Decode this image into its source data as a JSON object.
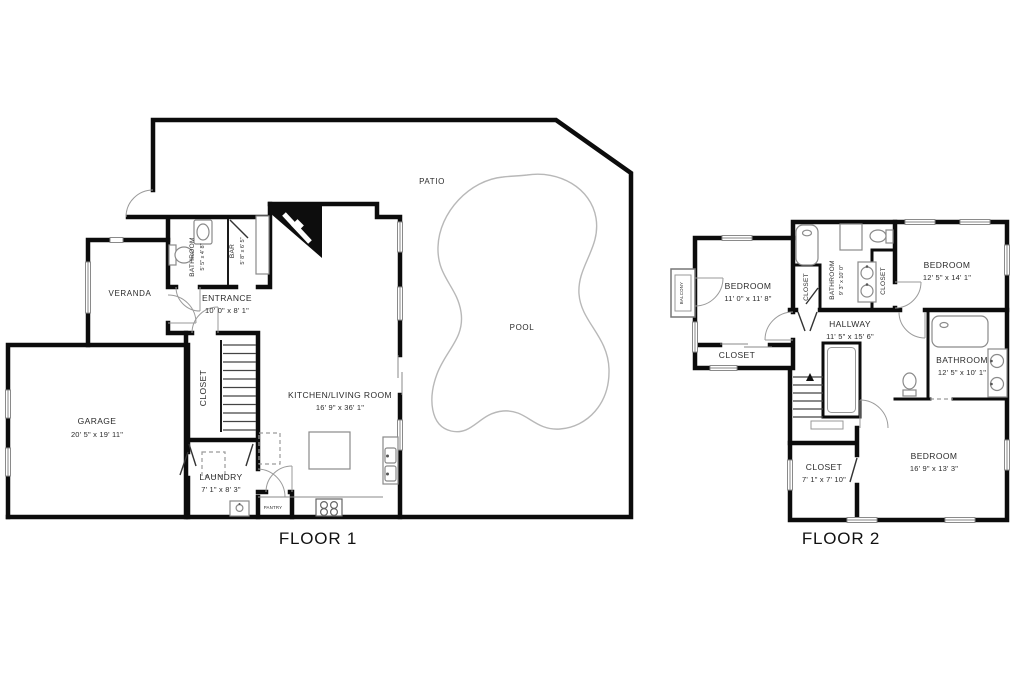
{
  "page": {
    "background": "#ffffff"
  },
  "colors": {
    "wall": "#0c0c0c",
    "fixture_line": "#8a8a8a",
    "text": "#2b2b2b"
  },
  "floor1": {
    "title": "FLOOR 1",
    "areas": {
      "patio": {
        "name": "PATIO"
      },
      "pool": {
        "name": "POOL"
      },
      "veranda": {
        "name": "VERANDA"
      }
    },
    "rooms": {
      "garage": {
        "name": "GARAGE",
        "dims": "20' 5\" x 19' 11\""
      },
      "bathroom": {
        "name": "BATHROOM",
        "dims": "5' 5\" x 4' 8\""
      },
      "bar": {
        "name": "BAR",
        "dims": "5' 8\" x 6' 5\""
      },
      "entrance": {
        "name": "ENTRANCE",
        "dims": "10' 0\" x 8' 1\""
      },
      "closet": {
        "name": "CLOSET"
      },
      "kitchen_living": {
        "name": "KITCHEN/LIVING ROOM",
        "dims": "16' 9\" x 36' 1\""
      },
      "laundry": {
        "name": "LAUNDRY",
        "dims": "7' 1\" x 8' 3\""
      },
      "pantry": {
        "name": "PANTRY"
      }
    }
  },
  "floor2": {
    "title": "FLOOR 2",
    "rooms": {
      "bedroom1": {
        "name": "BEDROOM",
        "dims": "11' 0\" x 11' 8\""
      },
      "balcony": {
        "name": "BALCONY"
      },
      "closet_strip": {
        "name": "CLOSET"
      },
      "closet_left": {
        "name": "CLOSET"
      },
      "bathroom_small": {
        "name": "BATHROOM",
        "dims": "9' 3\" x 10' 0\""
      },
      "closet_right": {
        "name": "CLOSET"
      },
      "bedroom2": {
        "name": "BEDROOM",
        "dims": "12' 5\" x 14' 1\""
      },
      "hallway": {
        "name": "HALLWAY",
        "dims": "11' 5\" x 15' 6\""
      },
      "bathroom_main": {
        "name": "BATHROOM",
        "dims": "12' 5\" x 10' 1\""
      },
      "bedroom3": {
        "name": "BEDROOM",
        "dims": "16' 9\" x 13' 3\""
      },
      "closet4": {
        "name": "CLOSET",
        "dims": "7' 1\" x 7' 10\""
      }
    }
  }
}
